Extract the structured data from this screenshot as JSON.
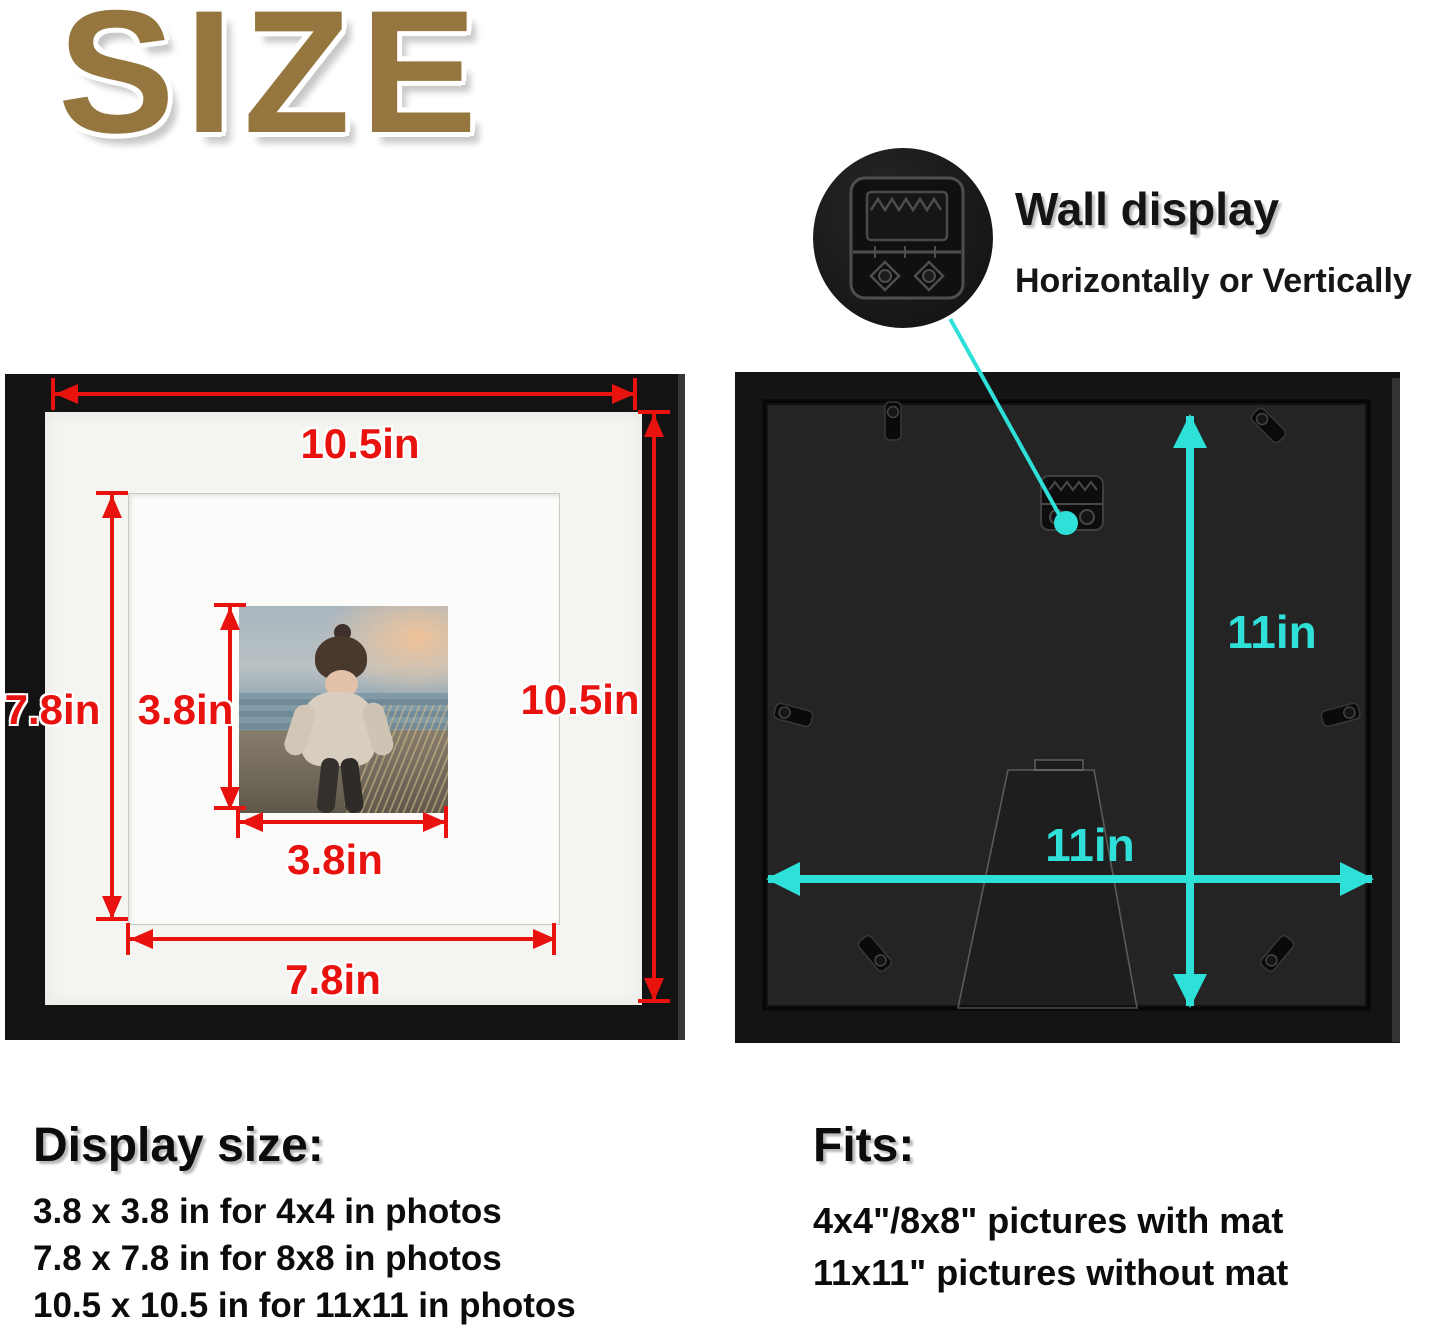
{
  "title": "SIZE",
  "front_frame": {
    "width_label": "10.5in",
    "height_label": "10.5in",
    "mat_height_label": "7.8in",
    "mat_width_label": "7.8in",
    "photo_height_label": "3.8in",
    "photo_width_label": "3.8in"
  },
  "back_frame": {
    "height_label": "11in",
    "width_label": "11in"
  },
  "wall_display": {
    "heading": "Wall display",
    "subheading": "Horizontally or Vertically"
  },
  "display_size": {
    "heading": "Display size:",
    "lines": [
      "3.8 x 3.8 in for 4x4 in photos",
      "7.8 x 7.8 in for 8x8 in photos",
      "10.5 x 10.5 in for 11x11 in photos"
    ]
  },
  "fits": {
    "heading": "Fits:",
    "lines": [
      "4x4\"/8x8\" pictures with mat",
      "11x11\" pictures without mat"
    ]
  },
  "colors": {
    "dimension_red": "#e8120f",
    "dimension_cyan": "#2ee0d8",
    "title_gold": "#94763e"
  }
}
